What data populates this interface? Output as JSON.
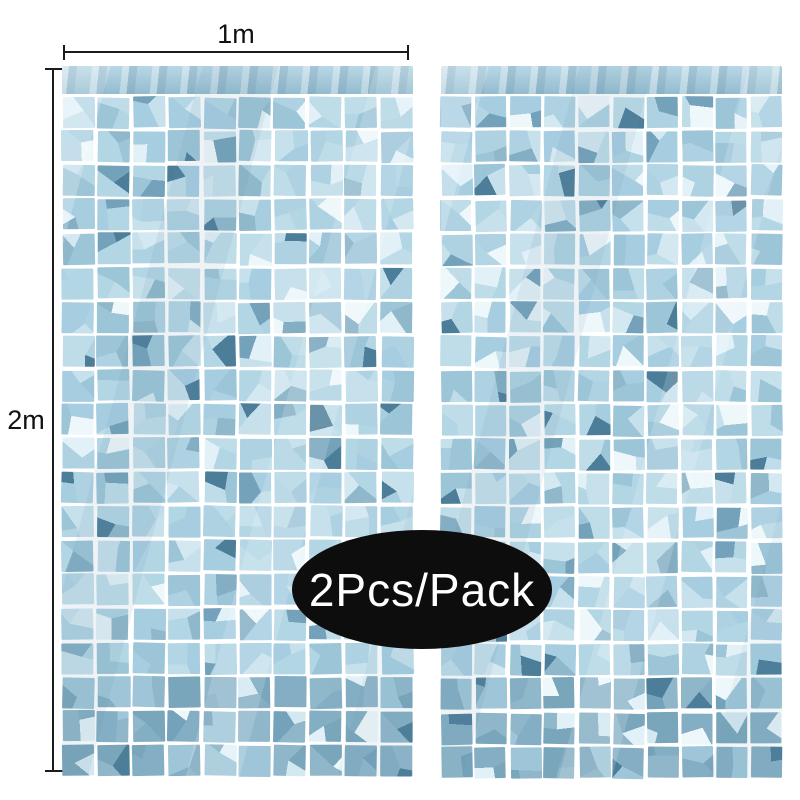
{
  "annotations": {
    "width_label": "1m",
    "height_label": "2m",
    "line_color": "#1b1b1b",
    "label_color": "#111111"
  },
  "badge": {
    "label": "2Pcs/Pack",
    "background": "#0d0d0d",
    "text_color": "#ffffff"
  },
  "curtain": {
    "panel_count": 2,
    "columns": 10,
    "rows": 20,
    "palette": {
      "light": [
        "#b3d6e5",
        "#a6cde0",
        "#bedde9",
        "#9cc5d8",
        "#aed2e2",
        "#c6e0ec"
      ],
      "mid": [
        "#84aec3",
        "#74a2ba",
        "#8fb8cb"
      ],
      "shade": [
        "#8fb6c9",
        "#84aec3",
        "#9ec6d8",
        "#7aa6bc"
      ],
      "highlight": [
        "#e2f1f7",
        "#d3e8f1",
        "#eef7fa"
      ],
      "deep": "#4d7e99",
      "header_top": "#b9d8e6",
      "header_bottom": "#93bccf",
      "gap": "#ffffff"
    }
  }
}
